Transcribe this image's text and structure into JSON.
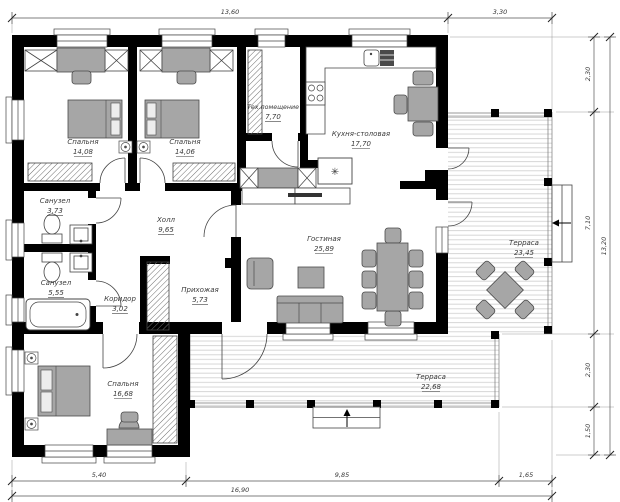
{
  "rooms": [
    {
      "name": "Спальня",
      "area": "14,08"
    },
    {
      "name": "Спальня",
      "area": "14,06"
    },
    {
      "name": "Тех.помещение",
      "area": "7,70"
    },
    {
      "name": "Кухня-столовая",
      "area": "17,70"
    },
    {
      "name": "Санузел",
      "area": "3,73"
    },
    {
      "name": "Холл",
      "area": "9,65"
    },
    {
      "name": "Санузел",
      "area": "5,55"
    },
    {
      "name": "Коридор",
      "area": "3,02"
    },
    {
      "name": "Прихожая",
      "area": "5,73"
    },
    {
      "name": "Гостиная",
      "area": "25,89"
    },
    {
      "name": "Терраса",
      "area": "23,45"
    },
    {
      "name": "Спальня",
      "area": "16,68"
    },
    {
      "name": "Терраса",
      "area": "22,68"
    }
  ],
  "dims": {
    "top": [
      "13,60",
      "3,30"
    ],
    "right": [
      "2,30",
      "7,10",
      "2,30",
      "1,50"
    ],
    "right_total": "13,20",
    "bottom": [
      "5,40",
      "9,85",
      "1,65"
    ],
    "bottom_total": "16,90"
  },
  "symbols": {
    "fan": "✳"
  },
  "colors": {
    "wall": "#000000",
    "furniture": "#a6a6a6",
    "deck": "#d2d2d2",
    "text": "#3a3a3a"
  }
}
